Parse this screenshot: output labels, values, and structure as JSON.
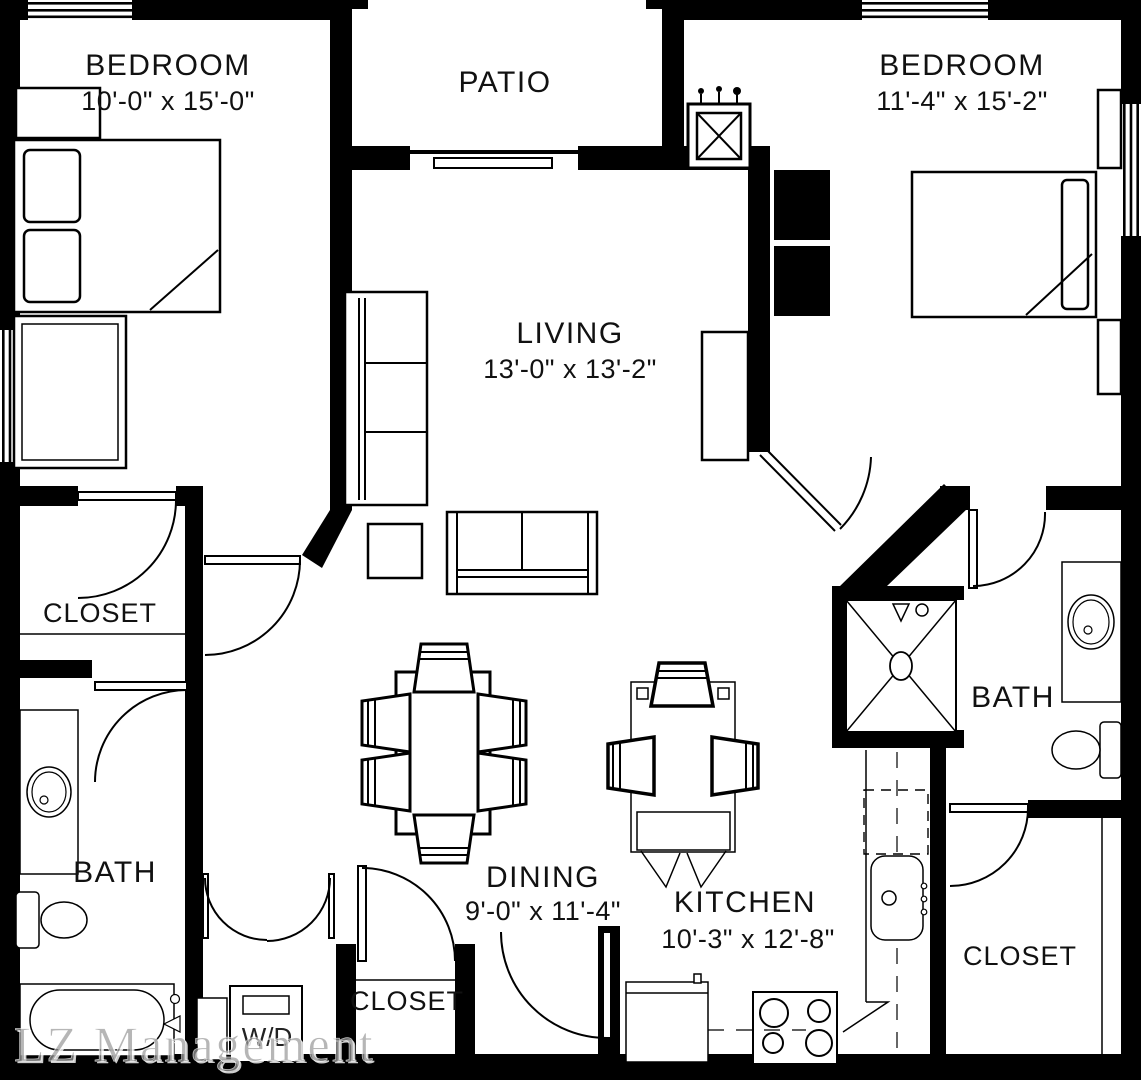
{
  "plan": {
    "title": "Two bedroom apartment floor plan",
    "watermark": "LZ Management",
    "colors": {
      "wall": "#000000",
      "background": "#ffffff",
      "watermark": "#9a9a9a",
      "text": "#111111"
    },
    "rooms": [
      {
        "id": "bedroom-left",
        "name": "BEDROOM",
        "dims": "10'-0\" x 15'-0\""
      },
      {
        "id": "patio",
        "name": "PATIO"
      },
      {
        "id": "bedroom-right",
        "name": "BEDROOM",
        "dims": "11'-4\" x 15'-2\""
      },
      {
        "id": "living",
        "name": "LIVING",
        "dims": "13'-0\" x 13'-2\""
      },
      {
        "id": "closet-left",
        "name": "CLOSET"
      },
      {
        "id": "bath-left",
        "name": "BATH"
      },
      {
        "id": "dining",
        "name": "DINING",
        "dims": "9'-0\" x 11'-4\""
      },
      {
        "id": "kitchen",
        "name": "KITCHEN",
        "dims": "10'-3\" x 12'-8\""
      },
      {
        "id": "bath-right",
        "name": "BATH"
      },
      {
        "id": "closet-right",
        "name": "CLOSET"
      },
      {
        "id": "closet-hall",
        "name": "CLOSET"
      },
      {
        "id": "washer-dryer",
        "name": "W/D"
      }
    ]
  }
}
